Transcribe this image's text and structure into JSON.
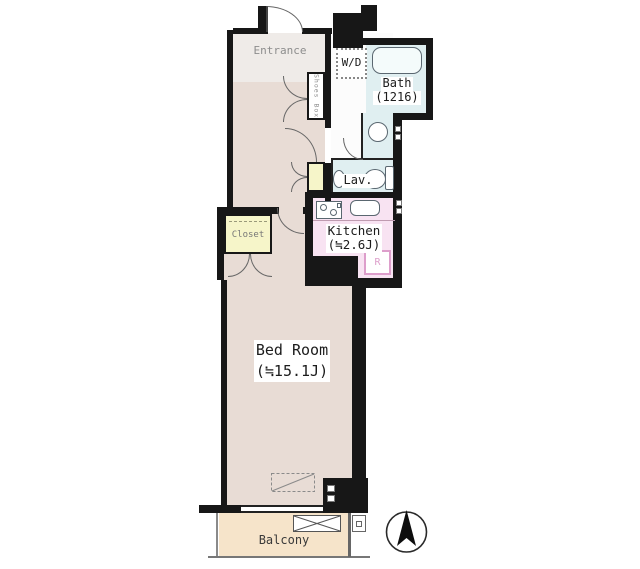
{
  "plan_title": "apartment-floor-plan",
  "rooms": {
    "entrance": {
      "label": "Entrance"
    },
    "shoes_box": {
      "label": "Shoes Box"
    },
    "washer_dryer": {
      "label": "W/D"
    },
    "bath": {
      "label": "Bath",
      "size": "(1216)"
    },
    "lavatory": {
      "label": "Lav."
    },
    "kitchen": {
      "label": "Kitchen",
      "size": "(≒2.6J)"
    },
    "refrigerator": {
      "label": "R"
    },
    "closet": {
      "label": "Closet"
    },
    "bedroom": {
      "label": "Bed Room",
      "size": "(≒15.1J)"
    },
    "balcony": {
      "label": "Balcony"
    }
  },
  "icons": [
    "north-compass-icon",
    "bathtub-icon",
    "toilet-icon",
    "washbasin-icon",
    "stove-icon",
    "kitchen-sink-icon",
    "door-arc",
    "ac-unit-box",
    "drain-box"
  ],
  "colors": {
    "wall": "#171717",
    "floor": "#e8dcd5",
    "entrance": "#efebe8",
    "wet": "#e0eff1",
    "kitchen": "#f8e3f2",
    "closet": "#f6f5c9",
    "balcony": "#f6e4ca",
    "accent_pink": "#dd9ecb",
    "line": "#666666"
  }
}
